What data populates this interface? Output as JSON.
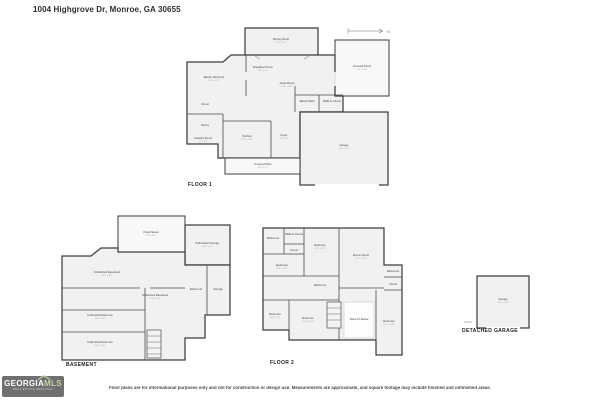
{
  "header": {
    "title": "1004 Highgrove Dr, Monroe, GA 30655"
  },
  "compass": "N",
  "plans": [
    {
      "id": "floor1",
      "caption": "FLOOR 1",
      "labels": [
        {
          "text": "Dining Room",
          "dims": "12'4\" x 11'6\"",
          "x": 98,
          "y": 14
        },
        {
          "text": "Covered Porch",
          "dims": "17'2\" x 18'0\"",
          "x": 179,
          "y": 41
        },
        {
          "text": "Master Bedroom",
          "dims": "15'6\" x 13'1\"",
          "x": 31,
          "y": 52
        },
        {
          "text": "Breakfast Room",
          "dims": "11'2\" x 9'8\"",
          "x": 80,
          "y": 42
        },
        {
          "text": "Great Room",
          "dims": "18'4\" x 16'0\"",
          "x": 104,
          "y": 58
        },
        {
          "text": "Closet",
          "x": 22,
          "y": 79
        },
        {
          "text": "Pantry",
          "x": 22,
          "y": 100
        },
        {
          "text": "Laundry Room",
          "dims": "7'1\" x 6'2\"",
          "x": 20,
          "y": 113
        },
        {
          "text": "Kitchen",
          "dims": "13'0\" x 12'4\"",
          "x": 64,
          "y": 111
        },
        {
          "text": "Foyer",
          "dims": "7'6\" x 5'8\"",
          "x": 101,
          "y": 110
        },
        {
          "text": "Master Bath",
          "x": 124,
          "y": 76
        },
        {
          "text": "Walk-in Closet",
          "x": 149,
          "y": 76
        },
        {
          "text": "Covered Patio",
          "dims": "24'0\" x 5'0\"",
          "x": 80,
          "y": 139
        },
        {
          "text": "Garage",
          "dims": "21'5\" x 21'2\"",
          "x": 161,
          "y": 120
        }
      ]
    },
    {
      "id": "basement",
      "caption": "BASEMENT",
      "labels": [
        {
          "text": "Crawl Space",
          "dims": "21'0\" x 11'0\"",
          "x": 96,
          "y": 21
        },
        {
          "text": "Unfinished Storage",
          "dims": "13'2\" x 11'4\"",
          "x": 152,
          "y": 32
        },
        {
          "text": "Unfinished Basement",
          "dims": "24'0\" x 9'6\"",
          "x": 52,
          "y": 61
        },
        {
          "text": "Unfinished Basement",
          "dims": "12'0\" x 20'0\"",
          "x": 100,
          "y": 84
        },
        {
          "text": "Bathroom",
          "x": 141,
          "y": 78
        },
        {
          "text": "Storage",
          "x": 163,
          "y": 78
        },
        {
          "text": "Unfinished Bedroom",
          "dims": "23'0\" x 6'8\"",
          "x": 45,
          "y": 104
        },
        {
          "text": "Unfinished Bedroom",
          "dims": "23'0\" x 8'0\"",
          "x": 45,
          "y": 131
        }
      ]
    },
    {
      "id": "floor2",
      "caption": "FLOOR 2",
      "labels": [
        {
          "text": "Bathroom",
          "x": 11,
          "y": 15
        },
        {
          "text": "Walk-in Closet",
          "x": 32,
          "y": 11
        },
        {
          "text": "Closet",
          "x": 32,
          "y": 27
        },
        {
          "text": "Bedroom",
          "dims": "12'2\" x 11'6\"",
          "x": 58,
          "y": 22
        },
        {
          "text": "Bonus Room",
          "dims": "15'0\" x 19'4\"",
          "x": 99,
          "y": 32
        },
        {
          "text": "Bathroom",
          "x": 131,
          "y": 48
        },
        {
          "text": "Closet",
          "x": 131,
          "y": 61
        },
        {
          "text": "Bedroom",
          "dims": "12'4\" x 10'2\"",
          "x": 20,
          "y": 42
        },
        {
          "text": "Bathroom",
          "x": 58,
          "y": 62
        },
        {
          "text": "Bedroom",
          "dims": "11'0\" x 9'6\"",
          "x": 13,
          "y": 91
        },
        {
          "text": "Bedroom",
          "dims": "12'0\" x 11'8\"",
          "x": 46,
          "y": 95
        },
        {
          "text": "Open To Below",
          "x": 97,
          "y": 96
        },
        {
          "text": "Bedroom",
          "dims": "10'6\" x 13'0\"",
          "x": 127,
          "y": 98
        }
      ]
    },
    {
      "id": "garage",
      "caption": "DETACHED GARAGE",
      "labels": [
        {
          "text": "Garage",
          "dims": "23'8\" x 23'4\"",
          "x": 45,
          "y": 30
        }
      ]
    }
  ],
  "footer": {
    "disclaimer": "Floor plans are for informational purposes only and not for construction or design use. Measurements are approximate, and square footage may include finished and unfinished areas.",
    "logo": {
      "brand": "GEORGIA",
      "brand_accent": "MLS",
      "tagline": "REAL ESTATE SERVICES"
    }
  }
}
